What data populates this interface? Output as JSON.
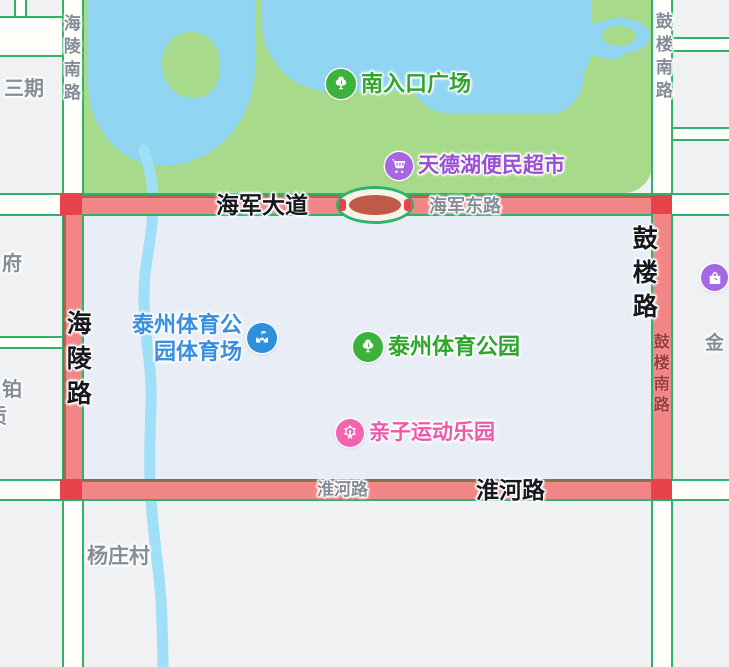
{
  "pois": {
    "south_entrance": {
      "name": "南入口广场",
      "icon": "tree-icon"
    },
    "supermarket": {
      "name": "天德湖便民超市",
      "icon": "cart-icon"
    },
    "stadium": {
      "name_line1": "泰州体育公",
      "name_line2": "园体育场",
      "icon": "stadium-icon"
    },
    "sports_park": {
      "name": "泰州体育公园",
      "icon": "tree-icon"
    },
    "kids_park": {
      "name": "亲子运动乐园",
      "icon": "ferris-wheel-icon"
    },
    "gold": {
      "name": "金",
      "icon": "shopping-bag-icon"
    }
  },
  "roads": {
    "hailing_south": "海陵南路",
    "hailing": "海陵路",
    "haijun_avenue": "海军大道",
    "haijun_east": "海军东路",
    "gulou_south_top": "鼓楼南路",
    "gulou": "鼓楼路",
    "gulou_south_on_road": "鼓楼南路",
    "huaihe_on_road": "淮河路",
    "huaihe_bold": "淮河路"
  },
  "places": {
    "sanqi": "三期",
    "fu": "府",
    "bo": "铂",
    "partial_char": "质",
    "yangzhuang": "杨庄村"
  },
  "colors": {
    "bg-gray": "#eff1f3",
    "selected-tint": "#e8edf6",
    "park-green": "#a8da8c",
    "water-blue": "#90d5f2",
    "river-blue": "#9fdff7",
    "road-edge-green": "#2eb26c",
    "highlight-red": "#f28585",
    "corner-red": "#e8434d",
    "casing-brown": "#9a5a40",
    "oval-red": "#c05a48",
    "poi-green": "#2fa52f",
    "poi-purple": "#9b4fd4",
    "poi-blue": "#3a8ede",
    "poi-pink": "#ee58ab",
    "icon-green": "#3db23b",
    "icon-purple": "#a767e2",
    "icon-blue": "#2e8fdc",
    "icon-pink": "#f263b0",
    "road-label-gray": "#868d98",
    "road-label-dark": "#16181d",
    "red-road-label": "#9c3a40"
  }
}
